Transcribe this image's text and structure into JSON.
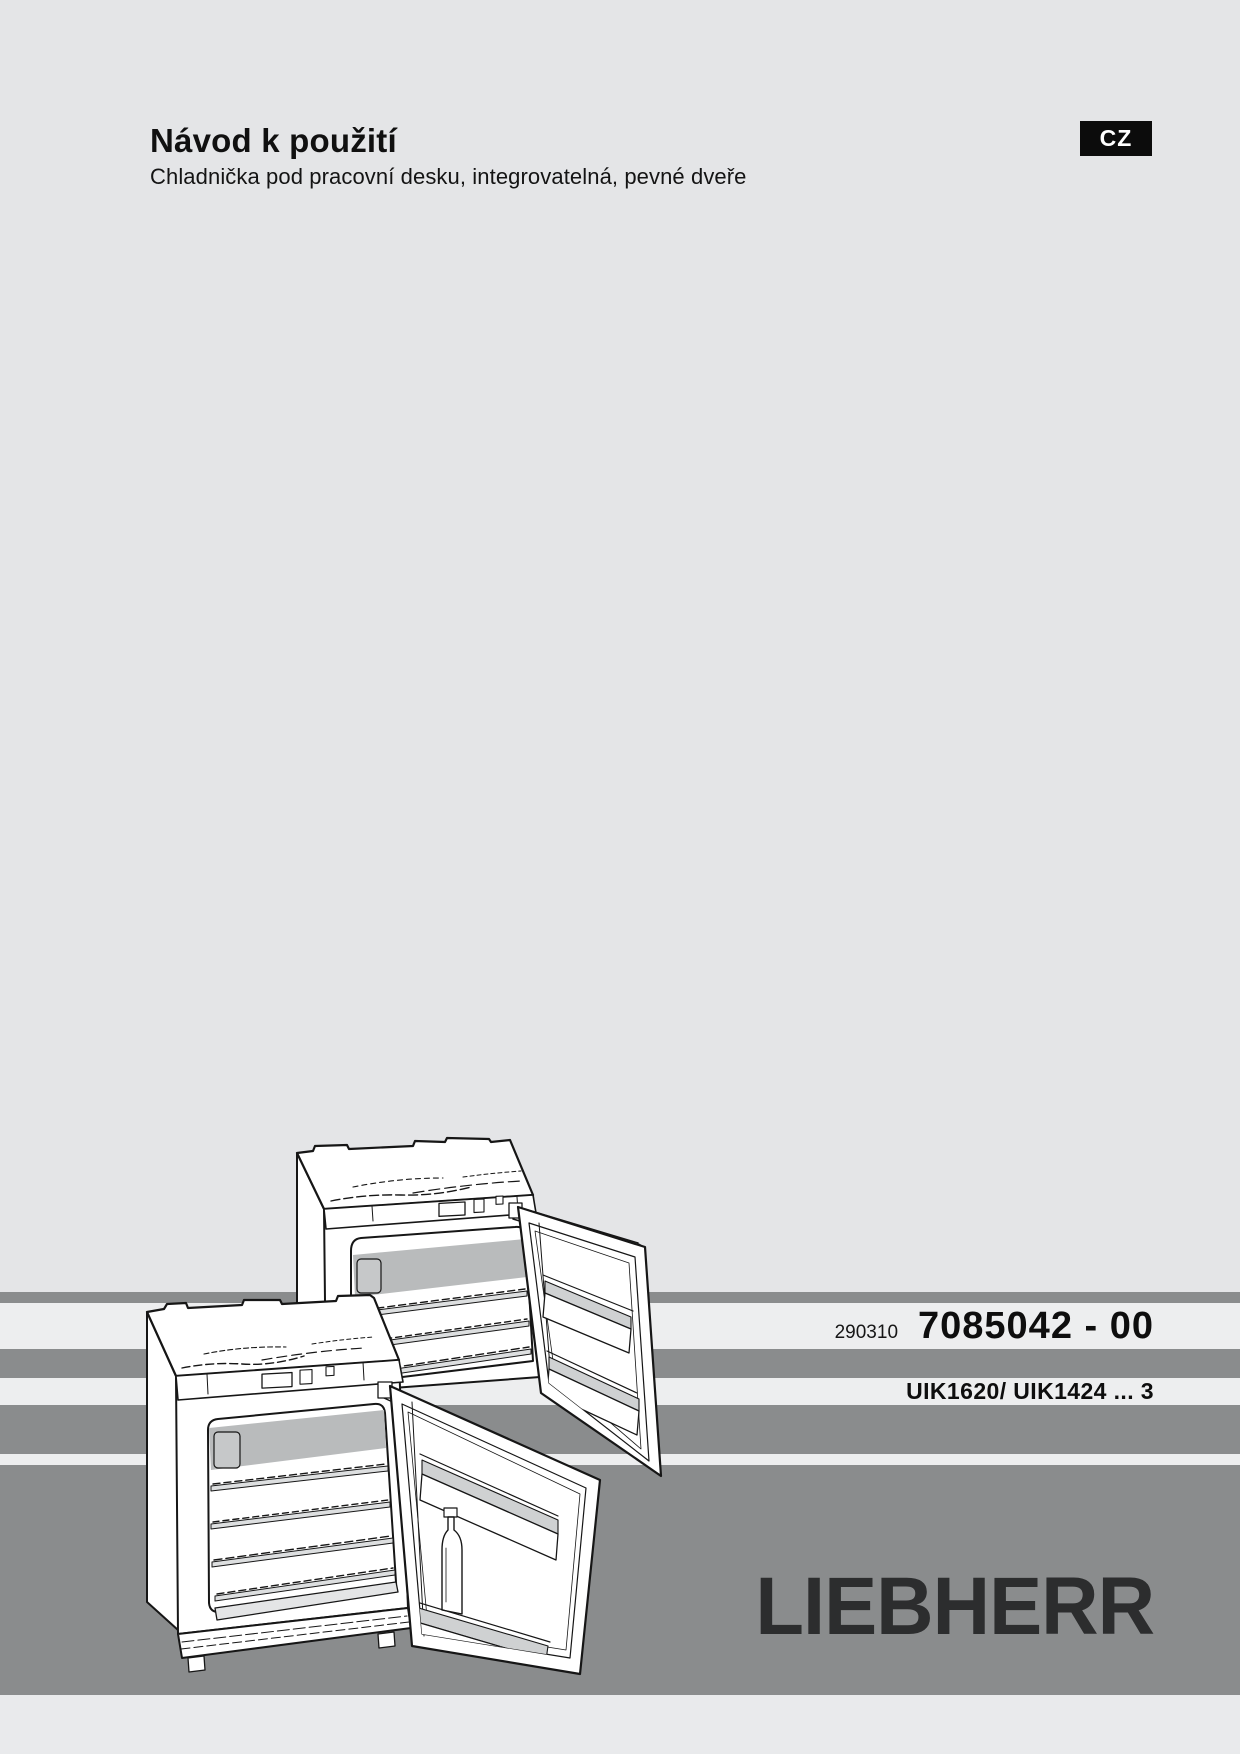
{
  "page": {
    "language_badge": "CZ"
  },
  "header": {
    "title": "Návod k použití",
    "subtitle": "Chladnička pod pracovní desku, integrovatelná, pevné dveře"
  },
  "product_strip": {
    "print_code": "290310",
    "document_number": "7085042 - 00",
    "models": "UIK1620/ UIK1424 ... 3"
  },
  "footer": {
    "brand": "LIEBHERR"
  },
  "illustration": {
    "description": "Line drawing of two built-under integrable refrigerators with open fixed doors, door racks and a bottle"
  },
  "colors": {
    "page_background": "#e4e5e7",
    "stripe_dark": "#8a8c8d",
    "stripe_light": "#edeeef",
    "badge_background": "#0c0c0c",
    "badge_text": "#ffffff",
    "logo_color": "#2c2d2e",
    "text_color": "#111111"
  }
}
